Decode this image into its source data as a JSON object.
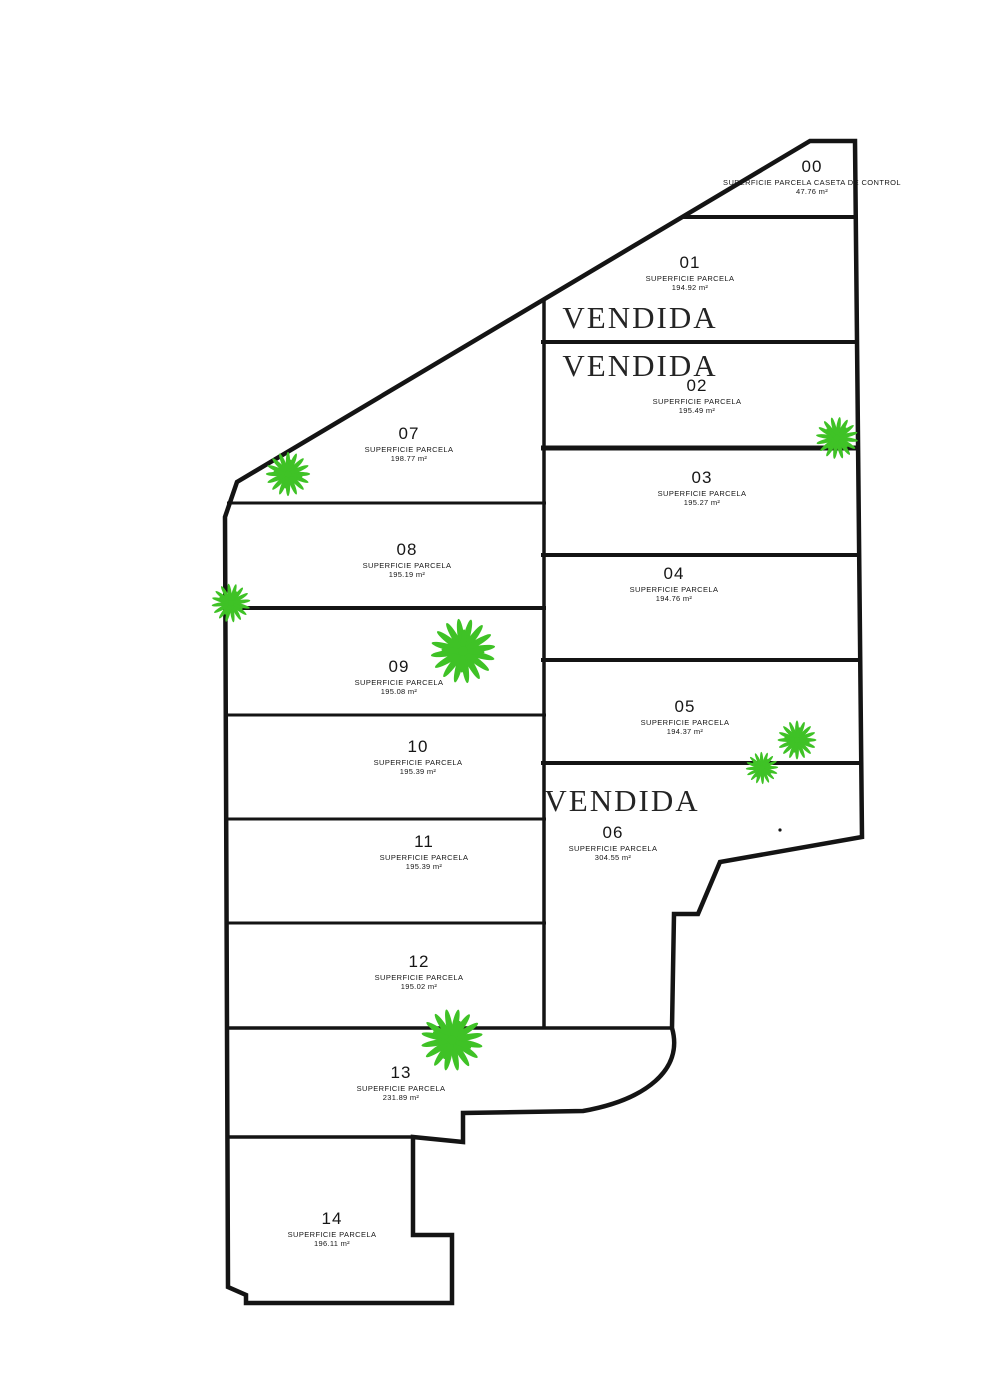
{
  "plan": {
    "type": "parcel-site-plan",
    "language": "es",
    "sold_label": "VENDIDA",
    "colors": {
      "line": "#141414",
      "background": "#ffffff",
      "plant_green": "#3fc226",
      "text": "#161616"
    }
  },
  "parcels": [
    {
      "number": "00",
      "superficie_label": "SUPERFICIE PARCELA CASETA DE CONTROL",
      "area": "47.76 m²"
    },
    {
      "number": "01",
      "superficie_label": "SUPERFICIE PARCELA",
      "area": "194.92 m²",
      "status": "VENDIDA"
    },
    {
      "number": "02",
      "superficie_label": "SUPERFICIE PARCELA",
      "area": "195.49 m²",
      "status": "VENDIDA"
    },
    {
      "number": "03",
      "superficie_label": "SUPERFICIE PARCELA",
      "area": "195.27 m²"
    },
    {
      "number": "04",
      "superficie_label": "SUPERFICIE PARCELA",
      "area": "194.76 m²"
    },
    {
      "number": "05",
      "superficie_label": "SUPERFICIE PARCELA",
      "area": "194.37 m²"
    },
    {
      "number": "06",
      "superficie_label": "SUPERFICIE PARCELA",
      "area": "304.55 m²",
      "status": "VENDIDA"
    },
    {
      "number": "07",
      "superficie_label": "SUPERFICIE PARCELA",
      "area": "198.77 m²"
    },
    {
      "number": "08",
      "superficie_label": "SUPERFICIE PARCELA",
      "area": "195.19 m²"
    },
    {
      "number": "09",
      "superficie_label": "SUPERFICIE PARCELA",
      "area": "195.08 m²"
    },
    {
      "number": "10",
      "superficie_label": "SUPERFICIE PARCELA",
      "area": "195.39 m²"
    },
    {
      "number": "11",
      "superficie_label": "SUPERFICIE PARCELA",
      "area": "195.39 m²"
    },
    {
      "number": "12",
      "superficie_label": "SUPERFICIE PARCELA",
      "area": "195.02 m²"
    },
    {
      "number": "13",
      "superficie_label": "SUPERFICIE PARCELA",
      "area": "231.89 m²"
    },
    {
      "number": "14",
      "superficie_label": "SUPERFICIE PARCELA",
      "area": "196.11 m²"
    }
  ],
  "vendida_instances": [
    {
      "label": "VENDIDA",
      "parcel": "01"
    },
    {
      "label": "VENDIDA",
      "parcel": "02"
    },
    {
      "label": "VENDIDA",
      "parcel": "06"
    }
  ]
}
